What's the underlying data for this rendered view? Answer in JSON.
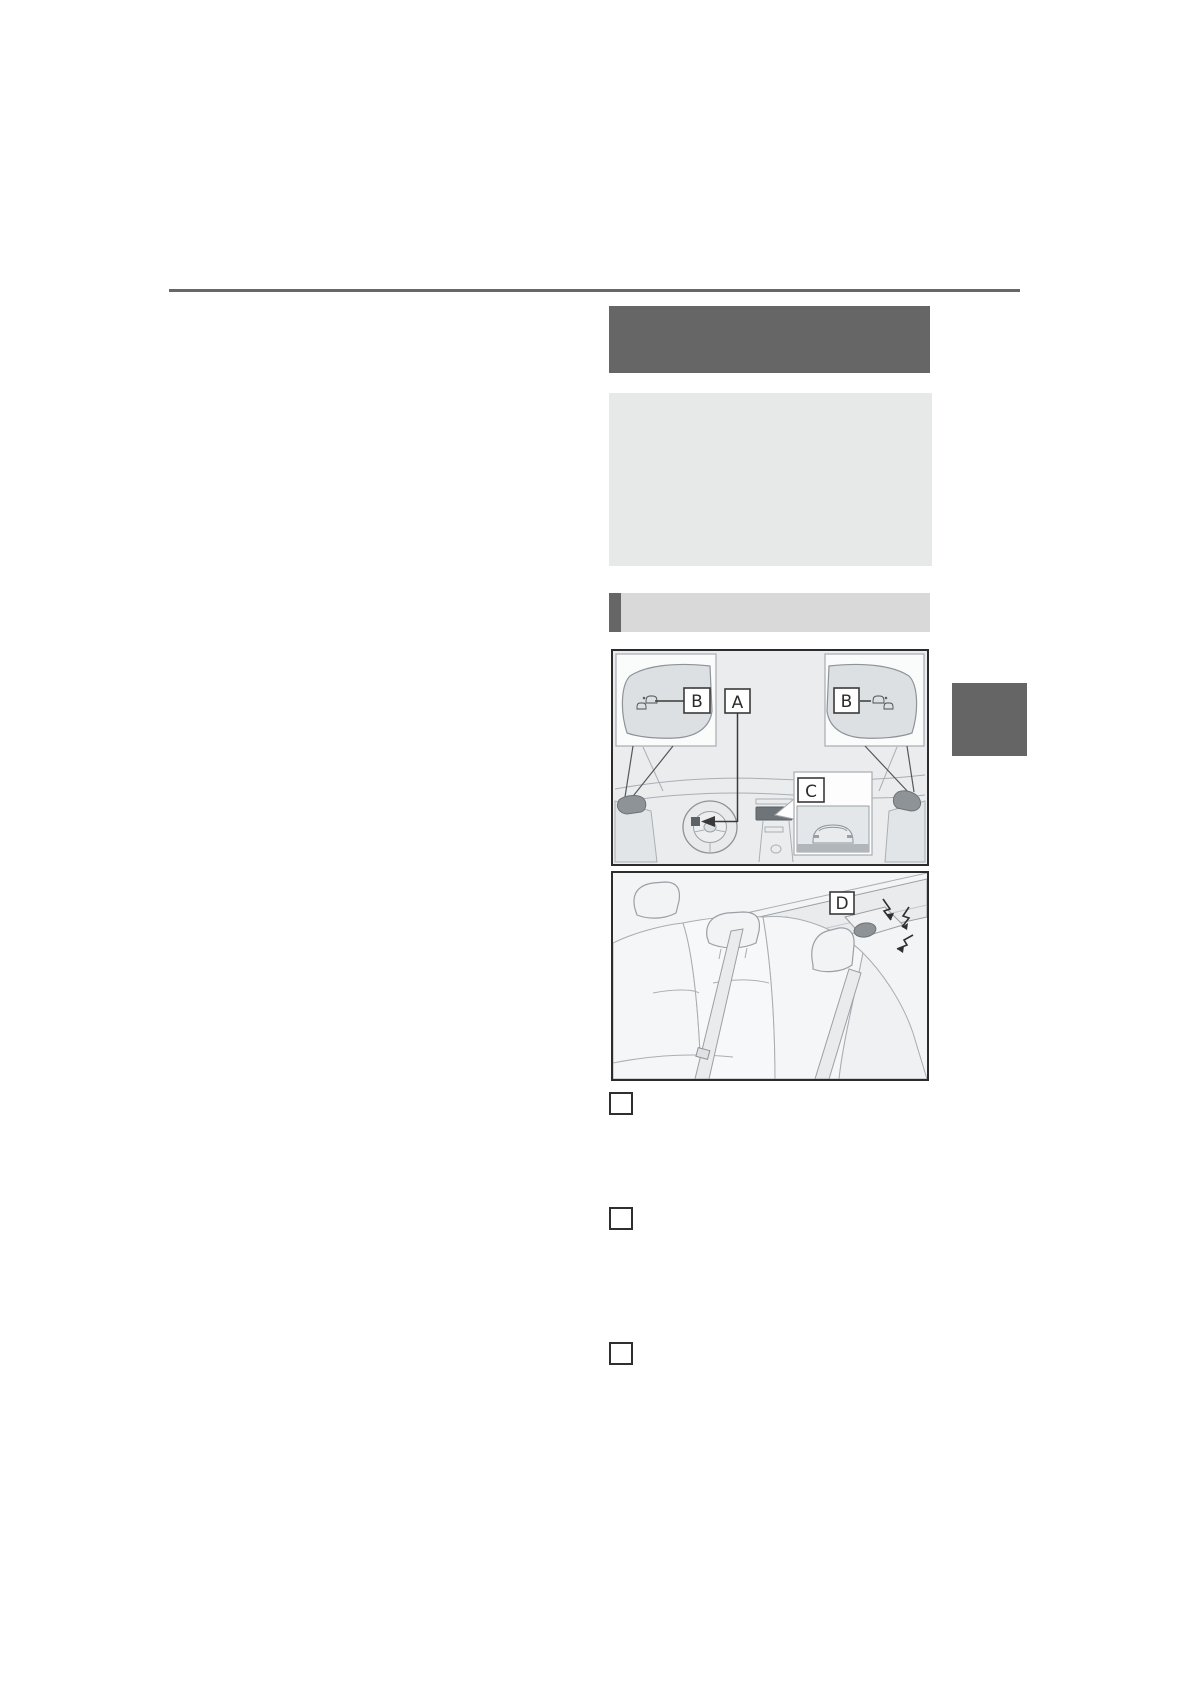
{
  "page": {
    "background": "#ffffff"
  },
  "colors": {
    "rule": "#666768",
    "header_box": "#666667",
    "info_box": "#e7e8e8",
    "section_bar": "#d9d9d9",
    "section_accent": "#666667",
    "chapter_tab": "#656566",
    "figure_border": "#2c2c2c",
    "figure1_bg": "#eaecee",
    "figure2_bg": "#f3f4f5",
    "display_screen": "#6f7478",
    "door_mirror": "#8e9398"
  },
  "figure1": {
    "label_a": "A",
    "label_b_left": "B",
    "label_b_right": "B",
    "label_c": "C"
  },
  "figure2": {
    "label_d": "D"
  },
  "legend": {
    "marker_1": "",
    "marker_2": "",
    "marker_3": ""
  }
}
